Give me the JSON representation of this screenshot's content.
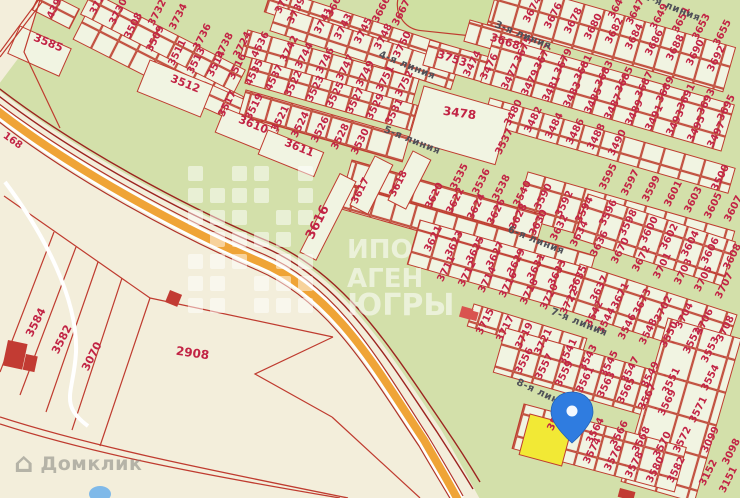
{
  "map": {
    "selected_plot": "3560",
    "domclick_label": "Домклик",
    "road_label": {
      "t": "168",
      "x": 11,
      "y": 143,
      "r": 36
    },
    "street_labels": [
      {
        "t": "2-я линия",
        "x": 671,
        "y": 10
      },
      {
        "t": "3-я линия",
        "x": 522,
        "y": 38
      },
      {
        "t": "4-я линия",
        "x": 406,
        "y": 68
      },
      {
        "t": "5-я линия",
        "x": 411,
        "y": 143
      },
      {
        "t": "6-я линия",
        "x": 535,
        "y": 243
      },
      {
        "t": "7-я линия",
        "x": 578,
        "y": 325
      },
      {
        "t": "8-я линия",
        "x": 543,
        "y": 397,
        "r": 25
      }
    ],
    "watermark": {
      "lines": [
        {
          "t": "ИПО",
          "x": 347,
          "y": 258,
          "s": 26
        },
        {
          "t": "АГЕН",
          "x": 347,
          "y": 287,
          "s": 26
        },
        {
          "t": "ЮГРЫ",
          "x": 347,
          "y": 315,
          "s": 30
        }
      ],
      "grid": {
        "x": 188,
        "y": 166,
        "cols": 6,
        "rows": 7,
        "cell": 15,
        "gap": 7,
        "skip": [
          1,
          4,
          10,
          15,
          18,
          23,
          27,
          32,
          38
        ]
      }
    },
    "colors": {
      "parcel_line": "#bf3b2f",
      "plot_number": "#c22445",
      "highway": "#efa437",
      "selected_plot": "#f2e935",
      "pin": "#2f7ce0",
      "water": "#7fb9e9",
      "green": "#d3e0aa",
      "beige": "#f3eedb"
    },
    "plot_labels": [
      {
        "t": "439",
        "x": 57,
        "y": 10
      },
      {
        "t": "3585",
        "x": 47,
        "y": 46,
        "r": 22,
        "s": 11
      },
      {
        "t": "372",
        "x": 100,
        "y": 6
      },
      {
        "t": "3730",
        "x": 121,
        "y": 13
      },
      {
        "t": "3508",
        "x": 136,
        "y": 27
      },
      {
        "t": "3732",
        "x": 160,
        "y": 14
      },
      {
        "t": "3509",
        "x": 158,
        "y": 40
      },
      {
        "t": "3734",
        "x": 181,
        "y": 18
      },
      {
        "t": "3511",
        "x": 180,
        "y": 54
      },
      {
        "t": "3736",
        "x": 205,
        "y": 38
      },
      {
        "t": "3513",
        "x": 199,
        "y": 62
      },
      {
        "t": "3738",
        "x": 227,
        "y": 47
      },
      {
        "t": "3514",
        "x": 219,
        "y": 65
      },
      {
        "t": "3724",
        "x": 245,
        "y": 46
      },
      {
        "t": "3516",
        "x": 240,
        "y": 68
      },
      {
        "t": "3512",
        "x": 184,
        "y": 87,
        "r": 22,
        "s": 11
      },
      {
        "t": "3517",
        "x": 230,
        "y": 105
      },
      {
        "t": "3519",
        "x": 257,
        "y": 108
      },
      {
        "t": "3610",
        "x": 252,
        "y": 128,
        "r": 22,
        "s": 11
      },
      {
        "t": "3611",
        "x": 298,
        "y": 151,
        "r": 22,
        "s": 11
      },
      {
        "t": "372",
        "x": 285,
        "y": 5
      },
      {
        "t": "3664",
        "x": 338,
        "y": 5
      },
      {
        "t": "3739",
        "x": 299,
        "y": 12
      },
      {
        "t": "3741",
        "x": 326,
        "y": 22
      },
      {
        "t": "3743",
        "x": 346,
        "y": 28
      },
      {
        "t": "3745",
        "x": 366,
        "y": 32
      },
      {
        "t": "3748",
        "x": 386,
        "y": 38
      },
      {
        "t": "3750",
        "x": 405,
        "y": 46
      },
      {
        "t": "3666",
        "x": 384,
        "y": 11
      },
      {
        "t": "3667",
        "x": 404,
        "y": 14
      },
      {
        "t": "3753",
        "x": 451,
        "y": 62,
        "r": 18,
        "s": 11
      },
      {
        "t": "3668",
        "x": 504,
        "y": 45,
        "r": 18,
        "s": 11
      },
      {
        "t": "3474",
        "x": 475,
        "y": 65
      },
      {
        "t": "3476",
        "x": 492,
        "y": 68
      },
      {
        "t": "4536",
        "x": 263,
        "y": 46
      },
      {
        "t": "3742",
        "x": 292,
        "y": 50
      },
      {
        "t": "3744",
        "x": 307,
        "y": 57
      },
      {
        "t": "3746",
        "x": 328,
        "y": 62
      },
      {
        "t": "3747",
        "x": 348,
        "y": 69
      },
      {
        "t": "3749",
        "x": 368,
        "y": 75
      },
      {
        "t": "3751",
        "x": 388,
        "y": 80
      },
      {
        "t": "3752",
        "x": 407,
        "y": 85
      },
      {
        "t": "4535",
        "x": 257,
        "y": 74
      },
      {
        "t": "4537",
        "x": 277,
        "y": 79
      },
      {
        "t": "3522",
        "x": 296,
        "y": 85
      },
      {
        "t": "3523",
        "x": 318,
        "y": 90
      },
      {
        "t": "3525",
        "x": 338,
        "y": 96
      },
      {
        "t": "3527",
        "x": 358,
        "y": 102
      },
      {
        "t": "3529",
        "x": 378,
        "y": 108
      },
      {
        "t": "3531",
        "x": 397,
        "y": 113
      },
      {
        "t": "3521",
        "x": 283,
        "y": 120
      },
      {
        "t": "3524",
        "x": 303,
        "y": 126
      },
      {
        "t": "3526",
        "x": 323,
        "y": 131
      },
      {
        "t": "3528",
        "x": 343,
        "y": 138
      },
      {
        "t": "3530",
        "x": 363,
        "y": 143
      },
      {
        "t": "3478",
        "x": 459,
        "y": 117,
        "r": 8,
        "s": 12
      },
      {
        "t": "3674",
        "x": 535,
        "y": 11
      },
      {
        "t": "3676",
        "x": 556,
        "y": 17
      },
      {
        "t": "3678",
        "x": 576,
        "y": 22
      },
      {
        "t": "3680",
        "x": 596,
        "y": 28
      },
      {
        "t": "3682",
        "x": 617,
        "y": 32
      },
      {
        "t": "3684",
        "x": 637,
        "y": 38
      },
      {
        "t": "3686",
        "x": 657,
        "y": 44
      },
      {
        "t": "3688",
        "x": 678,
        "y": 49
      },
      {
        "t": "3690",
        "x": 698,
        "y": 54
      },
      {
        "t": "3692",
        "x": 719,
        "y": 60
      },
      {
        "t": "3645",
        "x": 620,
        "y": 7
      },
      {
        "t": "3647",
        "x": 638,
        "y": 13
      },
      {
        "t": "3649",
        "x": 662,
        "y": 18
      },
      {
        "t": "3651",
        "x": 684,
        "y": 21
      },
      {
        "t": "3653",
        "x": 704,
        "y": 28
      },
      {
        "t": "3655",
        "x": 725,
        "y": 34
      },
      {
        "t": "3675",
        "x": 526,
        "y": 51
      },
      {
        "t": "3677",
        "x": 546,
        "y": 58
      },
      {
        "t": "3679",
        "x": 566,
        "y": 63
      },
      {
        "t": "3681",
        "x": 586,
        "y": 69
      },
      {
        "t": "3683",
        "x": 607,
        "y": 75
      },
      {
        "t": "3685",
        "x": 627,
        "y": 81
      },
      {
        "t": "3687",
        "x": 647,
        "y": 86
      },
      {
        "t": "3689",
        "x": 668,
        "y": 91
      },
      {
        "t": "3691",
        "x": 689,
        "y": 98
      },
      {
        "t": "3693",
        "x": 709,
        "y": 103
      },
      {
        "t": "3695",
        "x": 729,
        "y": 109
      },
      {
        "t": "3477",
        "x": 513,
        "y": 78
      },
      {
        "t": "3479",
        "x": 533,
        "y": 84
      },
      {
        "t": "3481",
        "x": 554,
        "y": 90
      },
      {
        "t": "3483",
        "x": 575,
        "y": 96
      },
      {
        "t": "3485",
        "x": 596,
        "y": 102
      },
      {
        "t": "3487",
        "x": 616,
        "y": 108
      },
      {
        "t": "3489",
        "x": 637,
        "y": 114
      },
      {
        "t": "3491",
        "x": 657,
        "y": 119
      },
      {
        "t": "3493",
        "x": 678,
        "y": 124
      },
      {
        "t": "3495",
        "x": 699,
        "y": 130
      },
      {
        "t": "3497",
        "x": 719,
        "y": 136
      },
      {
        "t": "3537",
        "x": 507,
        "y": 143
      },
      {
        "t": "3480",
        "x": 516,
        "y": 114
      },
      {
        "t": "3482",
        "x": 536,
        "y": 121
      },
      {
        "t": "3484",
        "x": 557,
        "y": 127
      },
      {
        "t": "3486",
        "x": 578,
        "y": 133
      },
      {
        "t": "3488",
        "x": 599,
        "y": 138
      },
      {
        "t": "3490",
        "x": 620,
        "y": 144
      },
      {
        "t": "3595",
        "x": 611,
        "y": 178
      },
      {
        "t": "3597",
        "x": 633,
        "y": 184
      },
      {
        "t": "3599",
        "x": 654,
        "y": 190
      },
      {
        "t": "3601",
        "x": 676,
        "y": 195
      },
      {
        "t": "3603",
        "x": 696,
        "y": 201
      },
      {
        "t": "3605",
        "x": 716,
        "y": 207
      },
      {
        "t": "3500",
        "x": 723,
        "y": 179
      },
      {
        "t": "3607",
        "x": 736,
        "y": 210
      },
      {
        "t": "3590",
        "x": 546,
        "y": 198
      },
      {
        "t": "3592",
        "x": 567,
        "y": 205
      },
      {
        "t": "3594",
        "x": 587,
        "y": 211
      },
      {
        "t": "3535",
        "x": 462,
        "y": 178
      },
      {
        "t": "3536",
        "x": 484,
        "y": 183
      },
      {
        "t": "3538",
        "x": 504,
        "y": 189
      },
      {
        "t": "3540",
        "x": 525,
        "y": 195
      },
      {
        "t": "3616",
        "x": 321,
        "y": 224,
        "s": 13
      },
      {
        "t": "3617",
        "x": 363,
        "y": 192
      },
      {
        "t": "3618",
        "x": 401,
        "y": 185
      },
      {
        "t": "3620",
        "x": 437,
        "y": 197
      },
      {
        "t": "3622",
        "x": 458,
        "y": 202
      },
      {
        "t": "3624",
        "x": 479,
        "y": 208
      },
      {
        "t": "3626",
        "x": 499,
        "y": 213
      },
      {
        "t": "3628",
        "x": 521,
        "y": 218
      },
      {
        "t": "3630",
        "x": 541,
        "y": 224
      },
      {
        "t": "3632",
        "x": 562,
        "y": 229
      },
      {
        "t": "3634",
        "x": 582,
        "y": 235
      },
      {
        "t": "3621",
        "x": 436,
        "y": 240
      },
      {
        "t": "3623",
        "x": 457,
        "y": 245
      },
      {
        "t": "3625",
        "x": 478,
        "y": 251
      },
      {
        "t": "3627",
        "x": 498,
        "y": 256
      },
      {
        "t": "3629",
        "x": 519,
        "y": 263
      },
      {
        "t": "3631",
        "x": 539,
        "y": 268
      },
      {
        "t": "3633",
        "x": 560,
        "y": 274
      },
      {
        "t": "3635",
        "x": 581,
        "y": 280
      },
      {
        "t": "3711",
        "x": 449,
        "y": 270
      },
      {
        "t": "3712",
        "x": 470,
        "y": 275
      },
      {
        "t": "3714",
        "x": 490,
        "y": 281
      },
      {
        "t": "3716",
        "x": 511,
        "y": 286
      },
      {
        "t": "3718",
        "x": 532,
        "y": 293
      },
      {
        "t": "3720",
        "x": 552,
        "y": 298
      },
      {
        "t": "3722",
        "x": 572,
        "y": 303
      },
      {
        "t": "3596",
        "x": 611,
        "y": 214
      },
      {
        "t": "3598",
        "x": 631,
        "y": 224
      },
      {
        "t": "3600",
        "x": 652,
        "y": 231
      },
      {
        "t": "3602",
        "x": 672,
        "y": 238
      },
      {
        "t": "3604",
        "x": 693,
        "y": 245
      },
      {
        "t": "3606",
        "x": 713,
        "y": 252
      },
      {
        "t": "3608",
        "x": 735,
        "y": 258
      },
      {
        "t": "3636",
        "x": 602,
        "y": 245
      },
      {
        "t": "3670",
        "x": 623,
        "y": 252
      },
      {
        "t": "3672",
        "x": 644,
        "y": 260
      },
      {
        "t": "3701",
        "x": 665,
        "y": 267
      },
      {
        "t": "3703",
        "x": 686,
        "y": 273
      },
      {
        "t": "3705",
        "x": 706,
        "y": 280
      },
      {
        "t": "3707",
        "x": 727,
        "y": 287
      },
      {
        "t": "3637",
        "x": 602,
        "y": 290
      },
      {
        "t": "3671",
        "x": 623,
        "y": 297
      },
      {
        "t": "3673",
        "x": 645,
        "y": 303
      },
      {
        "t": "3702",
        "x": 666,
        "y": 310
      },
      {
        "t": "3704",
        "x": 687,
        "y": 317
      },
      {
        "t": "3706",
        "x": 707,
        "y": 323
      },
      {
        "t": "3708",
        "x": 728,
        "y": 330
      },
      {
        "t": "3542",
        "x": 597,
        "y": 315
      },
      {
        "t": "3544",
        "x": 609,
        "y": 322
      },
      {
        "t": "3546",
        "x": 630,
        "y": 328
      },
      {
        "t": "3548",
        "x": 651,
        "y": 333
      },
      {
        "t": "3550",
        "x": 672,
        "y": 336
      },
      {
        "t": "3715",
        "x": 488,
        "y": 323
      },
      {
        "t": "3717",
        "x": 508,
        "y": 330
      },
      {
        "t": "3719",
        "x": 527,
        "y": 337
      },
      {
        "t": "3721",
        "x": 546,
        "y": 343
      },
      {
        "t": "3541",
        "x": 571,
        "y": 353
      },
      {
        "t": "3543",
        "x": 591,
        "y": 359
      },
      {
        "t": "3545",
        "x": 612,
        "y": 365
      },
      {
        "t": "3547",
        "x": 633,
        "y": 371
      },
      {
        "t": "3549",
        "x": 653,
        "y": 376
      },
      {
        "t": "3551",
        "x": 674,
        "y": 382
      },
      {
        "t": "3556",
        "x": 527,
        "y": 362
      },
      {
        "t": "3557",
        "x": 547,
        "y": 368
      },
      {
        "t": "3559",
        "x": 567,
        "y": 375
      },
      {
        "t": "3561",
        "x": 588,
        "y": 381
      },
      {
        "t": "3563",
        "x": 609,
        "y": 386
      },
      {
        "t": "3565",
        "x": 629,
        "y": 392
      },
      {
        "t": "3567",
        "x": 650,
        "y": 398
      },
      {
        "t": "3569",
        "x": 670,
        "y": 404
      },
      {
        "t": "3552",
        "x": 695,
        "y": 342
      },
      {
        "t": "3553",
        "x": 713,
        "y": 351
      },
      {
        "t": "3554",
        "x": 713,
        "y": 379
      },
      {
        "t": "3571",
        "x": 701,
        "y": 411
      },
      {
        "t": "3572",
        "x": 685,
        "y": 441
      },
      {
        "t": "3099",
        "x": 713,
        "y": 441
      },
      {
        "t": "3098",
        "x": 734,
        "y": 453
      },
      {
        "t": "3152",
        "x": 711,
        "y": 474
      },
      {
        "t": "3151",
        "x": 731,
        "y": 481
      },
      {
        "t": "3582",
        "x": 679,
        "y": 471
      },
      {
        "t": "3560",
        "x": 559,
        "y": 419
      },
      {
        "t": "3564",
        "x": 598,
        "y": 432
      },
      {
        "t": "3566",
        "x": 622,
        "y": 435
      },
      {
        "t": "3568",
        "x": 644,
        "y": 441
      },
      {
        "t": "3570",
        "x": 665,
        "y": 446
      },
      {
        "t": "3574",
        "x": 595,
        "y": 452
      },
      {
        "t": "3576",
        "x": 616,
        "y": 459
      },
      {
        "t": "3578",
        "x": 637,
        "y": 466
      },
      {
        "t": "3580",
        "x": 658,
        "y": 471
      },
      {
        "t": "3584",
        "x": 39,
        "y": 324,
        "s": 11
      },
      {
        "t": "3582",
        "x": 65,
        "y": 341,
        "s": 11
      },
      {
        "t": "3070",
        "x": 95,
        "y": 358,
        "s": 11
      },
      {
        "t": "2908",
        "x": 192,
        "y": 357,
        "r": 8,
        "s": 12
      }
    ]
  }
}
